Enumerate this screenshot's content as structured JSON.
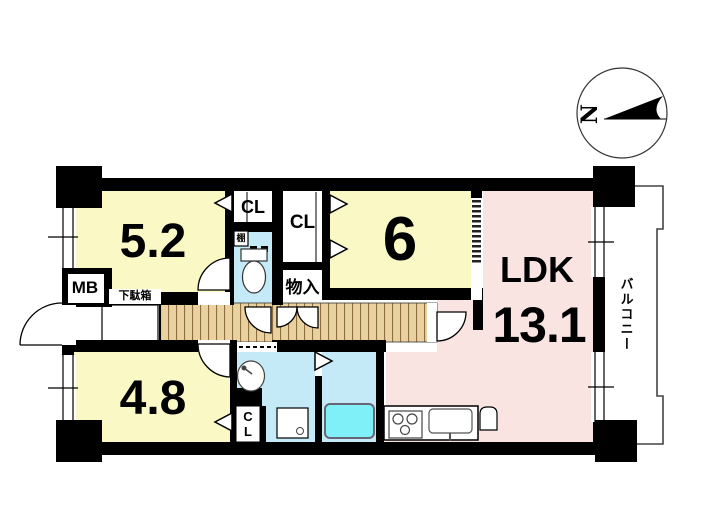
{
  "compass": {
    "north_label": "N"
  },
  "rooms": {
    "bedroom_5_2": {
      "label": "5.2"
    },
    "bedroom_6": {
      "label": "6"
    },
    "bedroom_4_8": {
      "label": "4.8"
    },
    "ldk": {
      "label": "LDK",
      "size": "13.1"
    },
    "balcony": {
      "label": "バルコニー"
    },
    "closet_top": {
      "label": "CL"
    },
    "closet_mid": {
      "label": "CL"
    },
    "closet_bottom": {
      "label": "CL"
    },
    "storage": {
      "label": "物入"
    },
    "shelf": {
      "label": "棚"
    },
    "meter_box": {
      "label": "MB"
    },
    "shoe_cabinet": {
      "label": "下駄箱"
    }
  },
  "colors": {
    "room_yellow": "#FAF8C4",
    "ldk_pink": "#FAE4E2",
    "wet_area_blue": "#C3EAF6",
    "bathtub_cyan": "#7FEFF8",
    "wood_floor": "#E9D2A0",
    "wood_stripe": "#8F6F3F",
    "wall_black": "#000000",
    "balcony_line": "#444444"
  }
}
